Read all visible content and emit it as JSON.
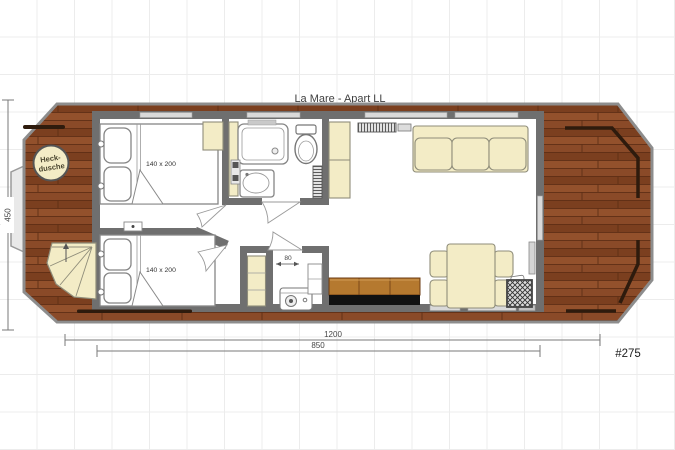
{
  "title": "La Mare - Apart LL",
  "plan_number": "#275",
  "labels": {
    "stern_shower_line1": "Heck-",
    "stern_shower_line2": "dusche",
    "bed1_size": "140 x 200",
    "bed2_size": "140 x 200"
  },
  "dimensions": {
    "overall_length": "1200",
    "cabin_length": "850",
    "beam_width": "450",
    "tech_niche_width": "80"
  },
  "colors": {
    "deck_wood": "#8a4a28",
    "wall_gray": "#6f6f6f",
    "furniture_cream": "#f3ecc6",
    "kitchen_counter_wood": "#b5792f",
    "kitchen_base_black": "#111111",
    "railing_brown": "#2e1b0d"
  }
}
